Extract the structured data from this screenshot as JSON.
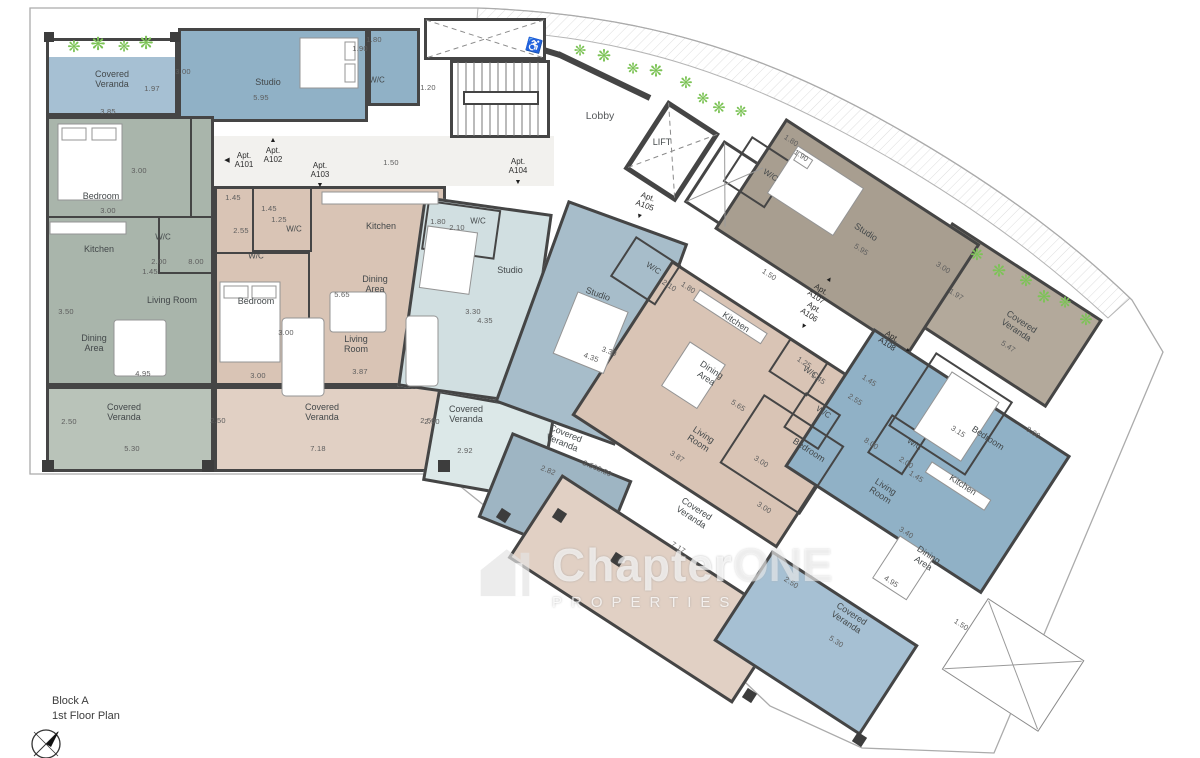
{
  "title_block": {
    "block": "Block A",
    "floor": "1st Floor Plan"
  },
  "watermark": {
    "word_main": "Chapter",
    "word_accent": "ONE",
    "subtitle": "PROPERTIES"
  },
  "apartments": [
    "A101",
    "A102",
    "A103",
    "A104",
    "A105",
    "A106",
    "A107",
    "A108"
  ],
  "palette": {
    "wall": "#454545",
    "corridor": "#f2f1ee",
    "plant_green": "#7cc356",
    "sage_room": "#a9b5ab",
    "sage_veranda": "#b9c3b9",
    "blue_room": "#90b1c6",
    "blue_veranda": "#a6c0d3",
    "tan_room": "#d9c4b5",
    "tan_veranda": "#e1d0c4",
    "pale_room": "#d1dfe1",
    "pale_veranda": "#dce8e8",
    "slate_room": "#a7bdca",
    "slate_veranda": "#9eb5c3",
    "taupe_room": "#a89e90",
    "taupe_veranda": "#b3a99b"
  },
  "plants": {
    "glyph": "❋",
    "color": "#7cc356",
    "positions": [
      [
        74,
        48,
        16
      ],
      [
        98,
        44,
        18
      ],
      [
        124,
        47,
        15
      ],
      [
        146,
        43,
        18
      ],
      [
        580,
        51,
        15
      ],
      [
        604,
        56,
        17
      ],
      [
        633,
        69,
        15
      ],
      [
        656,
        71,
        17
      ],
      [
        686,
        84,
        16
      ],
      [
        703,
        99,
        15
      ],
      [
        719,
        109,
        16
      ],
      [
        741,
        112,
        15
      ],
      [
        977,
        256,
        16
      ],
      [
        999,
        271,
        17
      ],
      [
        1026,
        282,
        16
      ],
      [
        1044,
        297,
        17
      ],
      [
        1065,
        303,
        15
      ],
      [
        1086,
        321,
        16
      ]
    ]
  },
  "labels": [
    {
      "t": "Lobby",
      "x": 600,
      "y": 117,
      "k": "room-lg"
    },
    {
      "t": "LIFT",
      "x": 662,
      "y": 142,
      "k": "room"
    },
    {
      "t": "1.20",
      "x": 428,
      "y": 88,
      "k": "dim"
    },
    {
      "t": "♿",
      "x": 534,
      "y": 46,
      "r": 15,
      "k": "icon"
    },
    {
      "t": "Apt.\nA101",
      "x": 244,
      "y": 161,
      "k": "apt"
    },
    {
      "t": "◀",
      "x": 227,
      "y": 161,
      "k": "arrow"
    },
    {
      "t": "Apt.\nA102",
      "x": 273,
      "y": 156,
      "k": "apt"
    },
    {
      "t": "▲",
      "x": 273,
      "y": 141,
      "k": "arrow"
    },
    {
      "t": "Apt.\nA103",
      "x": 320,
      "y": 171,
      "k": "apt"
    },
    {
      "t": "▼",
      "x": 320,
      "y": 186,
      "k": "arrow"
    },
    {
      "t": "1.50",
      "x": 391,
      "y": 163,
      "k": "dim"
    },
    {
      "t": "Apt.\nA104",
      "x": 518,
      "y": 167,
      "k": "apt"
    },
    {
      "t": "▼",
      "x": 518,
      "y": 183,
      "k": "arrow"
    },
    {
      "t": "Apt.\nA105",
      "x": 646,
      "y": 202,
      "r": 20,
      "k": "apt"
    },
    {
      "t": "▼",
      "x": 639,
      "y": 217,
      "r": 20,
      "k": "arrow"
    },
    {
      "t": "1.50",
      "x": 769,
      "y": 275,
      "r": 33,
      "k": "dim"
    },
    {
      "t": "Apt.\nA107",
      "x": 818,
      "y": 294,
      "r": 33,
      "k": "apt"
    },
    {
      "t": "▲",
      "x": 829,
      "y": 280,
      "r": 33,
      "k": "arrow"
    },
    {
      "t": "Apt.\nA106",
      "x": 811,
      "y": 312,
      "r": 33,
      "k": "apt"
    },
    {
      "t": "▼",
      "x": 803,
      "y": 327,
      "r": 33,
      "k": "arrow"
    },
    {
      "t": "Apt.\nA108",
      "x": 889,
      "y": 341,
      "r": 33,
      "k": "apt"
    },
    {
      "t": "▸",
      "x": 908,
      "y": 351,
      "r": 33,
      "k": "arrow"
    },
    {
      "t": "Covered\nVeranda",
      "x": 112,
      "y": 79,
      "k": "room"
    },
    {
      "t": "1.97",
      "x": 152,
      "y": 89,
      "k": "dim"
    },
    {
      "t": "3.85",
      "x": 108,
      "y": 112,
      "k": "dim"
    },
    {
      "t": "3.00",
      "x": 183,
      "y": 72,
      "k": "dim"
    },
    {
      "t": "Studio",
      "x": 268,
      "y": 82,
      "k": "room"
    },
    {
      "t": "5.95",
      "x": 261,
      "y": 98,
      "k": "dim"
    },
    {
      "t": "1.80",
      "x": 374,
      "y": 40,
      "k": "dim"
    },
    {
      "t": "1.90",
      "x": 360,
      "y": 49,
      "k": "dim"
    },
    {
      "t": "W/C",
      "x": 377,
      "y": 81,
      "k": "room-sm"
    },
    {
      "t": "Bedroom",
      "x": 101,
      "y": 196,
      "k": "room"
    },
    {
      "t": "3.00",
      "x": 139,
      "y": 171,
      "k": "dim"
    },
    {
      "t": "3.00",
      "x": 108,
      "y": 211,
      "k": "dim"
    },
    {
      "t": "Kitchen",
      "x": 99,
      "y": 249,
      "k": "room"
    },
    {
      "t": "W/C",
      "x": 163,
      "y": 238,
      "k": "room-sm"
    },
    {
      "t": "2.00",
      "x": 159,
      "y": 262,
      "k": "dim"
    },
    {
      "t": "1.45",
      "x": 150,
      "y": 272,
      "k": "dim"
    },
    {
      "t": "8.00",
      "x": 196,
      "y": 262,
      "k": "dim"
    },
    {
      "t": "Living Room",
      "x": 172,
      "y": 300,
      "k": "room"
    },
    {
      "t": "3.50",
      "x": 66,
      "y": 312,
      "k": "dim"
    },
    {
      "t": "Dining\nArea",
      "x": 94,
      "y": 343,
      "k": "room"
    },
    {
      "t": "4.95",
      "x": 143,
      "y": 374,
      "k": "dim"
    },
    {
      "t": "Covered\nVeranda",
      "x": 124,
      "y": 412,
      "k": "room"
    },
    {
      "t": "2.50",
      "x": 69,
      "y": 422,
      "k": "dim"
    },
    {
      "t": "5.30",
      "x": 132,
      "y": 449,
      "k": "dim"
    },
    {
      "t": "1.45",
      "x": 233,
      "y": 198,
      "k": "dim"
    },
    {
      "t": "2.55",
      "x": 241,
      "y": 231,
      "k": "dim"
    },
    {
      "t": "1.45",
      "x": 269,
      "y": 209,
      "k": "dim"
    },
    {
      "t": "1.25",
      "x": 279,
      "y": 220,
      "k": "dim"
    },
    {
      "t": "W/C",
      "x": 294,
      "y": 230,
      "k": "room-sm"
    },
    {
      "t": "W/C",
      "x": 256,
      "y": 257,
      "k": "room-sm"
    },
    {
      "t": "Bedroom",
      "x": 256,
      "y": 301,
      "k": "room"
    },
    {
      "t": "3.00",
      "x": 286,
      "y": 333,
      "k": "dim"
    },
    {
      "t": "3.00",
      "x": 258,
      "y": 376,
      "k": "dim"
    },
    {
      "t": "Kitchen",
      "x": 381,
      "y": 226,
      "k": "room"
    },
    {
      "t": "Dining\nArea",
      "x": 375,
      "y": 284,
      "k": "room"
    },
    {
      "t": "5.65",
      "x": 342,
      "y": 295,
      "k": "dim"
    },
    {
      "t": "Living\nRoom",
      "x": 356,
      "y": 344,
      "k": "room"
    },
    {
      "t": "3.87",
      "x": 360,
      "y": 372,
      "k": "dim"
    },
    {
      "t": "Covered\nVeranda",
      "x": 322,
      "y": 412,
      "k": "room"
    },
    {
      "t": "2.50",
      "x": 218,
      "y": 421,
      "k": "dim"
    },
    {
      "t": "7.18",
      "x": 318,
      "y": 449,
      "k": "dim"
    },
    {
      "t": "2.50",
      "x": 428,
      "y": 421,
      "k": "dim"
    },
    {
      "t": "1.80",
      "x": 438,
      "y": 222,
      "k": "dim"
    },
    {
      "t": "2.10",
      "x": 457,
      "y": 228,
      "k": "dim"
    },
    {
      "t": "W/C",
      "x": 478,
      "y": 222,
      "k": "room-sm"
    },
    {
      "t": "Studio",
      "x": 510,
      "y": 270,
      "k": "room"
    },
    {
      "t": "3.30",
      "x": 473,
      "y": 312,
      "k": "dim"
    },
    {
      "t": "4.35",
      "x": 485,
      "y": 321,
      "k": "dim"
    },
    {
      "t": "Covered\nVeranda",
      "x": 466,
      "y": 414,
      "k": "room"
    },
    {
      "t": "2.50",
      "x": 432,
      "y": 422,
      "k": "dim"
    },
    {
      "t": "2.92",
      "x": 465,
      "y": 451,
      "k": "dim"
    },
    {
      "t": "Studio",
      "x": 598,
      "y": 294,
      "r": 20,
      "k": "room"
    },
    {
      "t": "3.30",
      "x": 609,
      "y": 352,
      "r": 20,
      "k": "dim"
    },
    {
      "t": "4.35",
      "x": 591,
      "y": 358,
      "r": 20,
      "k": "dim"
    },
    {
      "t": "W/C",
      "x": 653,
      "y": 269,
      "r": 33,
      "k": "room-sm"
    },
    {
      "t": "2.10",
      "x": 669,
      "y": 286,
      "r": 33,
      "k": "dim"
    },
    {
      "t": "1.80",
      "x": 688,
      "y": 288,
      "r": 33,
      "k": "dim"
    },
    {
      "t": "Covered\nVeranda",
      "x": 564,
      "y": 438,
      "r": 22,
      "k": "room"
    },
    {
      "t": "2.82",
      "x": 548,
      "y": 471,
      "r": 22,
      "k": "dim"
    },
    {
      "t": "2.50",
      "x": 590,
      "y": 466,
      "r": 22,
      "k": "dim"
    },
    {
      "t": "Kitchen",
      "x": 736,
      "y": 322,
      "r": 33,
      "k": "room"
    },
    {
      "t": "Dining\nArea",
      "x": 709,
      "y": 374,
      "r": 33,
      "k": "room"
    },
    {
      "t": "5.65",
      "x": 738,
      "y": 406,
      "r": 33,
      "k": "dim"
    },
    {
      "t": "Living\nRoom",
      "x": 701,
      "y": 439,
      "r": 33,
      "k": "room"
    },
    {
      "t": "3.87",
      "x": 677,
      "y": 457,
      "r": 33,
      "k": "dim"
    },
    {
      "t": "3.00",
      "x": 761,
      "y": 462,
      "r": 33,
      "k": "dim"
    },
    {
      "t": "Bedroom",
      "x": 809,
      "y": 450,
      "r": 33,
      "k": "room"
    },
    {
      "t": "3.00",
      "x": 764,
      "y": 508,
      "r": 33,
      "k": "dim"
    },
    {
      "t": "1.25",
      "x": 804,
      "y": 363,
      "r": 33,
      "k": "dim"
    },
    {
      "t": "W/C",
      "x": 810,
      "y": 373,
      "r": 33,
      "k": "room-sm"
    },
    {
      "t": "1.45",
      "x": 818,
      "y": 379,
      "r": 33,
      "k": "dim"
    },
    {
      "t": "1.45",
      "x": 869,
      "y": 381,
      "r": 33,
      "k": "dim"
    },
    {
      "t": "2.55",
      "x": 855,
      "y": 400,
      "r": 33,
      "k": "dim"
    },
    {
      "t": "W/C",
      "x": 823,
      "y": 413,
      "r": 33,
      "k": "room-sm"
    },
    {
      "t": "Covered\nVeranda",
      "x": 694,
      "y": 513,
      "r": 33,
      "k": "room"
    },
    {
      "t": "7.17",
      "x": 678,
      "y": 548,
      "r": 33,
      "k": "dim"
    },
    {
      "t": "2.50",
      "x": 604,
      "y": 472,
      "r": 25,
      "k": "dim"
    },
    {
      "t": "W/C",
      "x": 770,
      "y": 176,
      "r": 33,
      "k": "room-sm"
    },
    {
      "t": "1.80",
      "x": 791,
      "y": 141,
      "r": 33,
      "k": "dim"
    },
    {
      "t": "1.90",
      "x": 801,
      "y": 156,
      "r": 33,
      "k": "dim"
    },
    {
      "t": "Studio",
      "x": 866,
      "y": 232,
      "r": 33,
      "k": "room"
    },
    {
      "t": "5.95",
      "x": 861,
      "y": 250,
      "r": 33,
      "k": "dim"
    },
    {
      "t": "3.00",
      "x": 943,
      "y": 268,
      "r": 33,
      "k": "dim"
    },
    {
      "t": "Covered\nVeranda",
      "x": 1019,
      "y": 326,
      "r": 33,
      "k": "room"
    },
    {
      "t": "1.97",
      "x": 956,
      "y": 295,
      "r": 33,
      "k": "dim"
    },
    {
      "t": "5.47",
      "x": 1008,
      "y": 347,
      "r": 33,
      "k": "dim"
    },
    {
      "t": "Bedroom",
      "x": 988,
      "y": 438,
      "r": 33,
      "k": "room"
    },
    {
      "t": "3.15",
      "x": 958,
      "y": 432,
      "r": 33,
      "k": "dim"
    },
    {
      "t": "3.00",
      "x": 1033,
      "y": 433,
      "r": 33,
      "k": "dim"
    },
    {
      "t": "W/C",
      "x": 914,
      "y": 445,
      "r": 33,
      "k": "room-sm"
    },
    {
      "t": "2.00",
      "x": 906,
      "y": 463,
      "r": 33,
      "k": "dim"
    },
    {
      "t": "1.45",
      "x": 916,
      "y": 477,
      "r": 33,
      "k": "dim"
    },
    {
      "t": "8.00",
      "x": 871,
      "y": 444,
      "r": 33,
      "k": "dim"
    },
    {
      "t": "Kitchen",
      "x": 963,
      "y": 485,
      "r": 33,
      "k": "room"
    },
    {
      "t": "Living\nRoom",
      "x": 883,
      "y": 491,
      "r": 33,
      "k": "room"
    },
    {
      "t": "3.40",
      "x": 906,
      "y": 533,
      "r": 33,
      "k": "dim"
    },
    {
      "t": "Dining\nArea",
      "x": 926,
      "y": 559,
      "r": 33,
      "k": "room"
    },
    {
      "t": "4.95",
      "x": 891,
      "y": 582,
      "r": 33,
      "k": "dim"
    },
    {
      "t": "Covered\nVeranda",
      "x": 849,
      "y": 618,
      "r": 33,
      "k": "room"
    },
    {
      "t": "2.50",
      "x": 791,
      "y": 583,
      "r": 33,
      "k": "dim"
    },
    {
      "t": "5.30",
      "x": 836,
      "y": 642,
      "r": 33,
      "k": "dim"
    },
    {
      "t": "1.50",
      "x": 961,
      "y": 625,
      "r": 33,
      "k": "dim"
    }
  ]
}
